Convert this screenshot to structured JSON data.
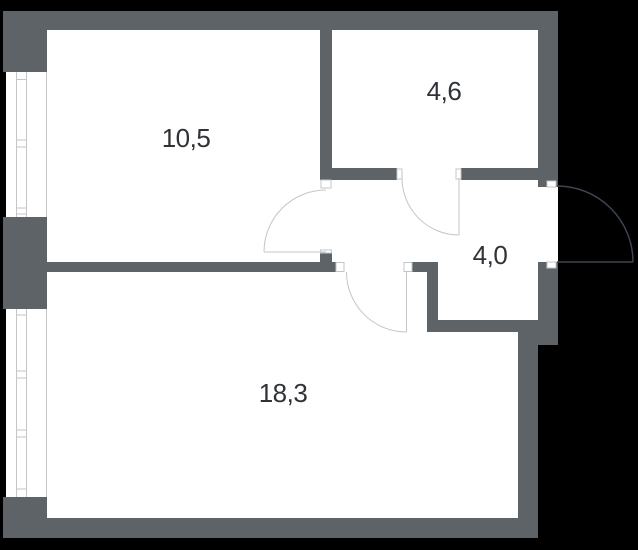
{
  "plan": {
    "type": "apartment-floor-plan",
    "rooms": [
      {
        "id": "room-top-left",
        "area_label": "10,5"
      },
      {
        "id": "room-top-right",
        "area_label": "4,6"
      },
      {
        "id": "hall-middle-right",
        "area_label": "4,0"
      },
      {
        "id": "room-bottom",
        "area_label": "18,3"
      }
    ],
    "colors": {
      "background": "#000000",
      "floor": "#ffffff",
      "wall": "#5e6367",
      "line": "#c3c5c8",
      "entry_door": "#3e4551",
      "label_text": "#2f3237"
    }
  }
}
